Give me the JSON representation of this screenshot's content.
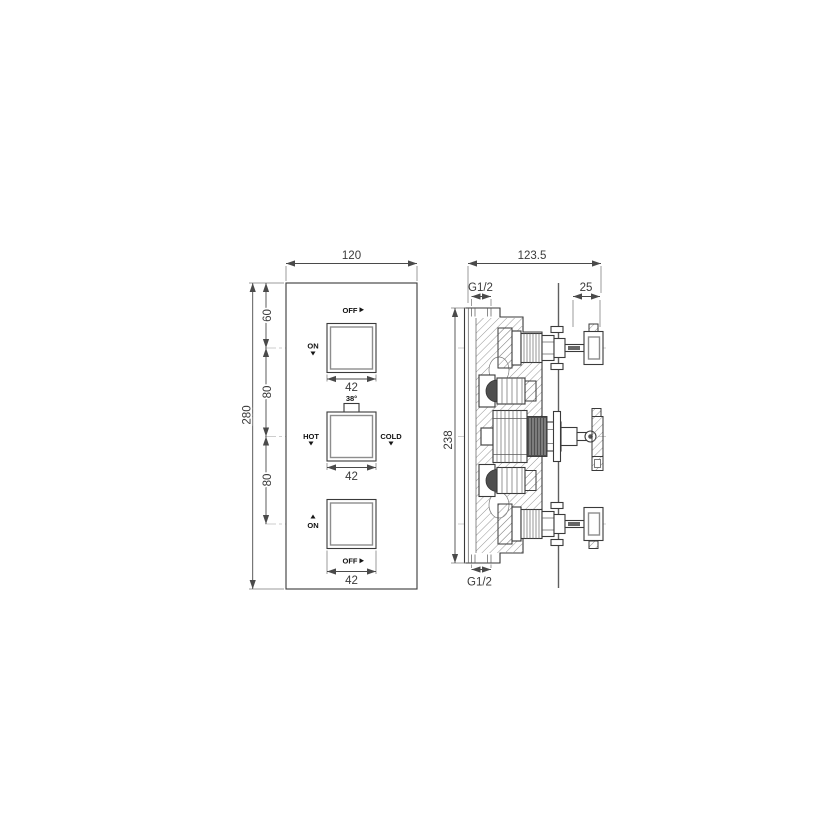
{
  "front_view": {
    "width_dim": "120",
    "height_dim": "280",
    "top_offset_dim": "60",
    "spacing_dim_upper": "80",
    "spacing_dim_lower": "80",
    "knob_top": {
      "size_dim": "42",
      "off_label": "OFF",
      "on_label": "ON"
    },
    "knob_middle": {
      "size_dim": "42",
      "temp_label": "38°",
      "hot_label": "HOT",
      "cold_label": "COLD"
    },
    "knob_bottom": {
      "size_dim": "42",
      "on_label": "ON",
      "off_label": "OFF"
    }
  },
  "side_view": {
    "depth_dim": "123.5",
    "height_dim": "238",
    "top_inlet_label": "G1/2",
    "bottom_inlet_label": "G1/2",
    "protrusion_dim": "25"
  },
  "colors": {
    "line": "#3a3a3a",
    "dark_fill": "#4f4f4f",
    "centerline": "#bdbdbd"
  }
}
